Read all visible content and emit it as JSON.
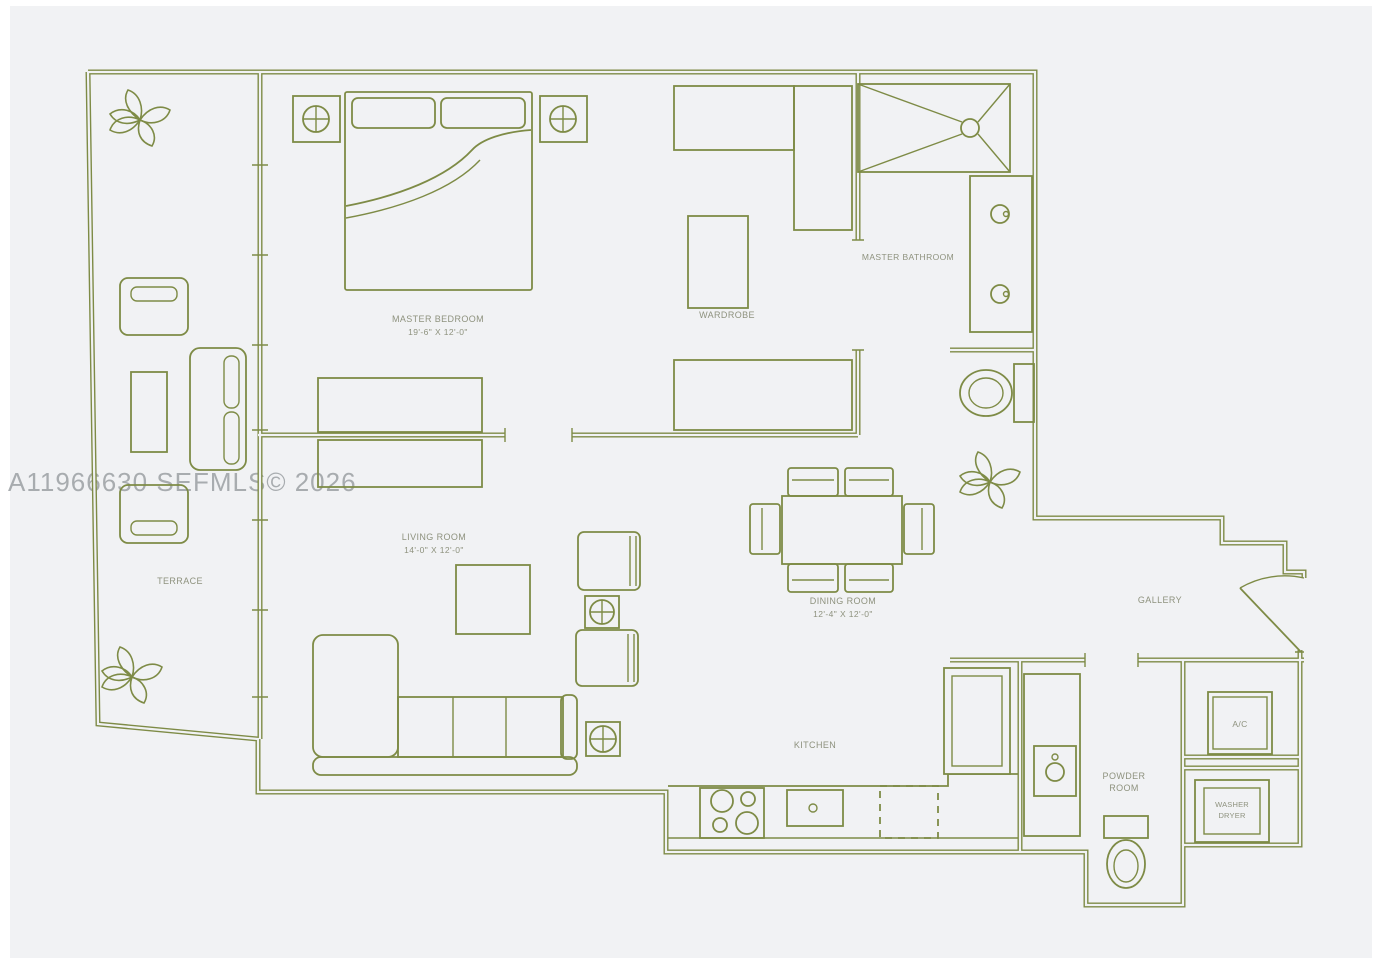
{
  "watermark": "A11966630 SEFMLS© 2026",
  "colors": {
    "wall": "#7e8b46",
    "background": "#f1f2f4",
    "label": "#8e927e",
    "watermark": "#9ca0a4"
  },
  "rooms": {
    "master_bedroom": {
      "label": "MASTER BEDROOM",
      "dims": "19'-6\" X 12'-0\""
    },
    "wardrobe": {
      "label": "WARDROBE"
    },
    "master_bathroom": {
      "label": "MASTER BATHROOM"
    },
    "living_room": {
      "label": "LIVING ROOM",
      "dims": "14'-0\" X 12'-0\""
    },
    "dining_room": {
      "label": "DINING ROOM",
      "dims": "12'-4\" X 12'-0\""
    },
    "terrace": {
      "label": "TERRACE"
    },
    "gallery": {
      "label": "GALLERY"
    },
    "kitchen": {
      "label": "KITCHEN"
    },
    "powder_room": {
      "line1": "POWDER",
      "line2": "ROOM"
    },
    "ac_closet": {
      "label": "A/C"
    },
    "washer_dryer": {
      "line1": "WASHER",
      "line2": "DRYER"
    }
  }
}
